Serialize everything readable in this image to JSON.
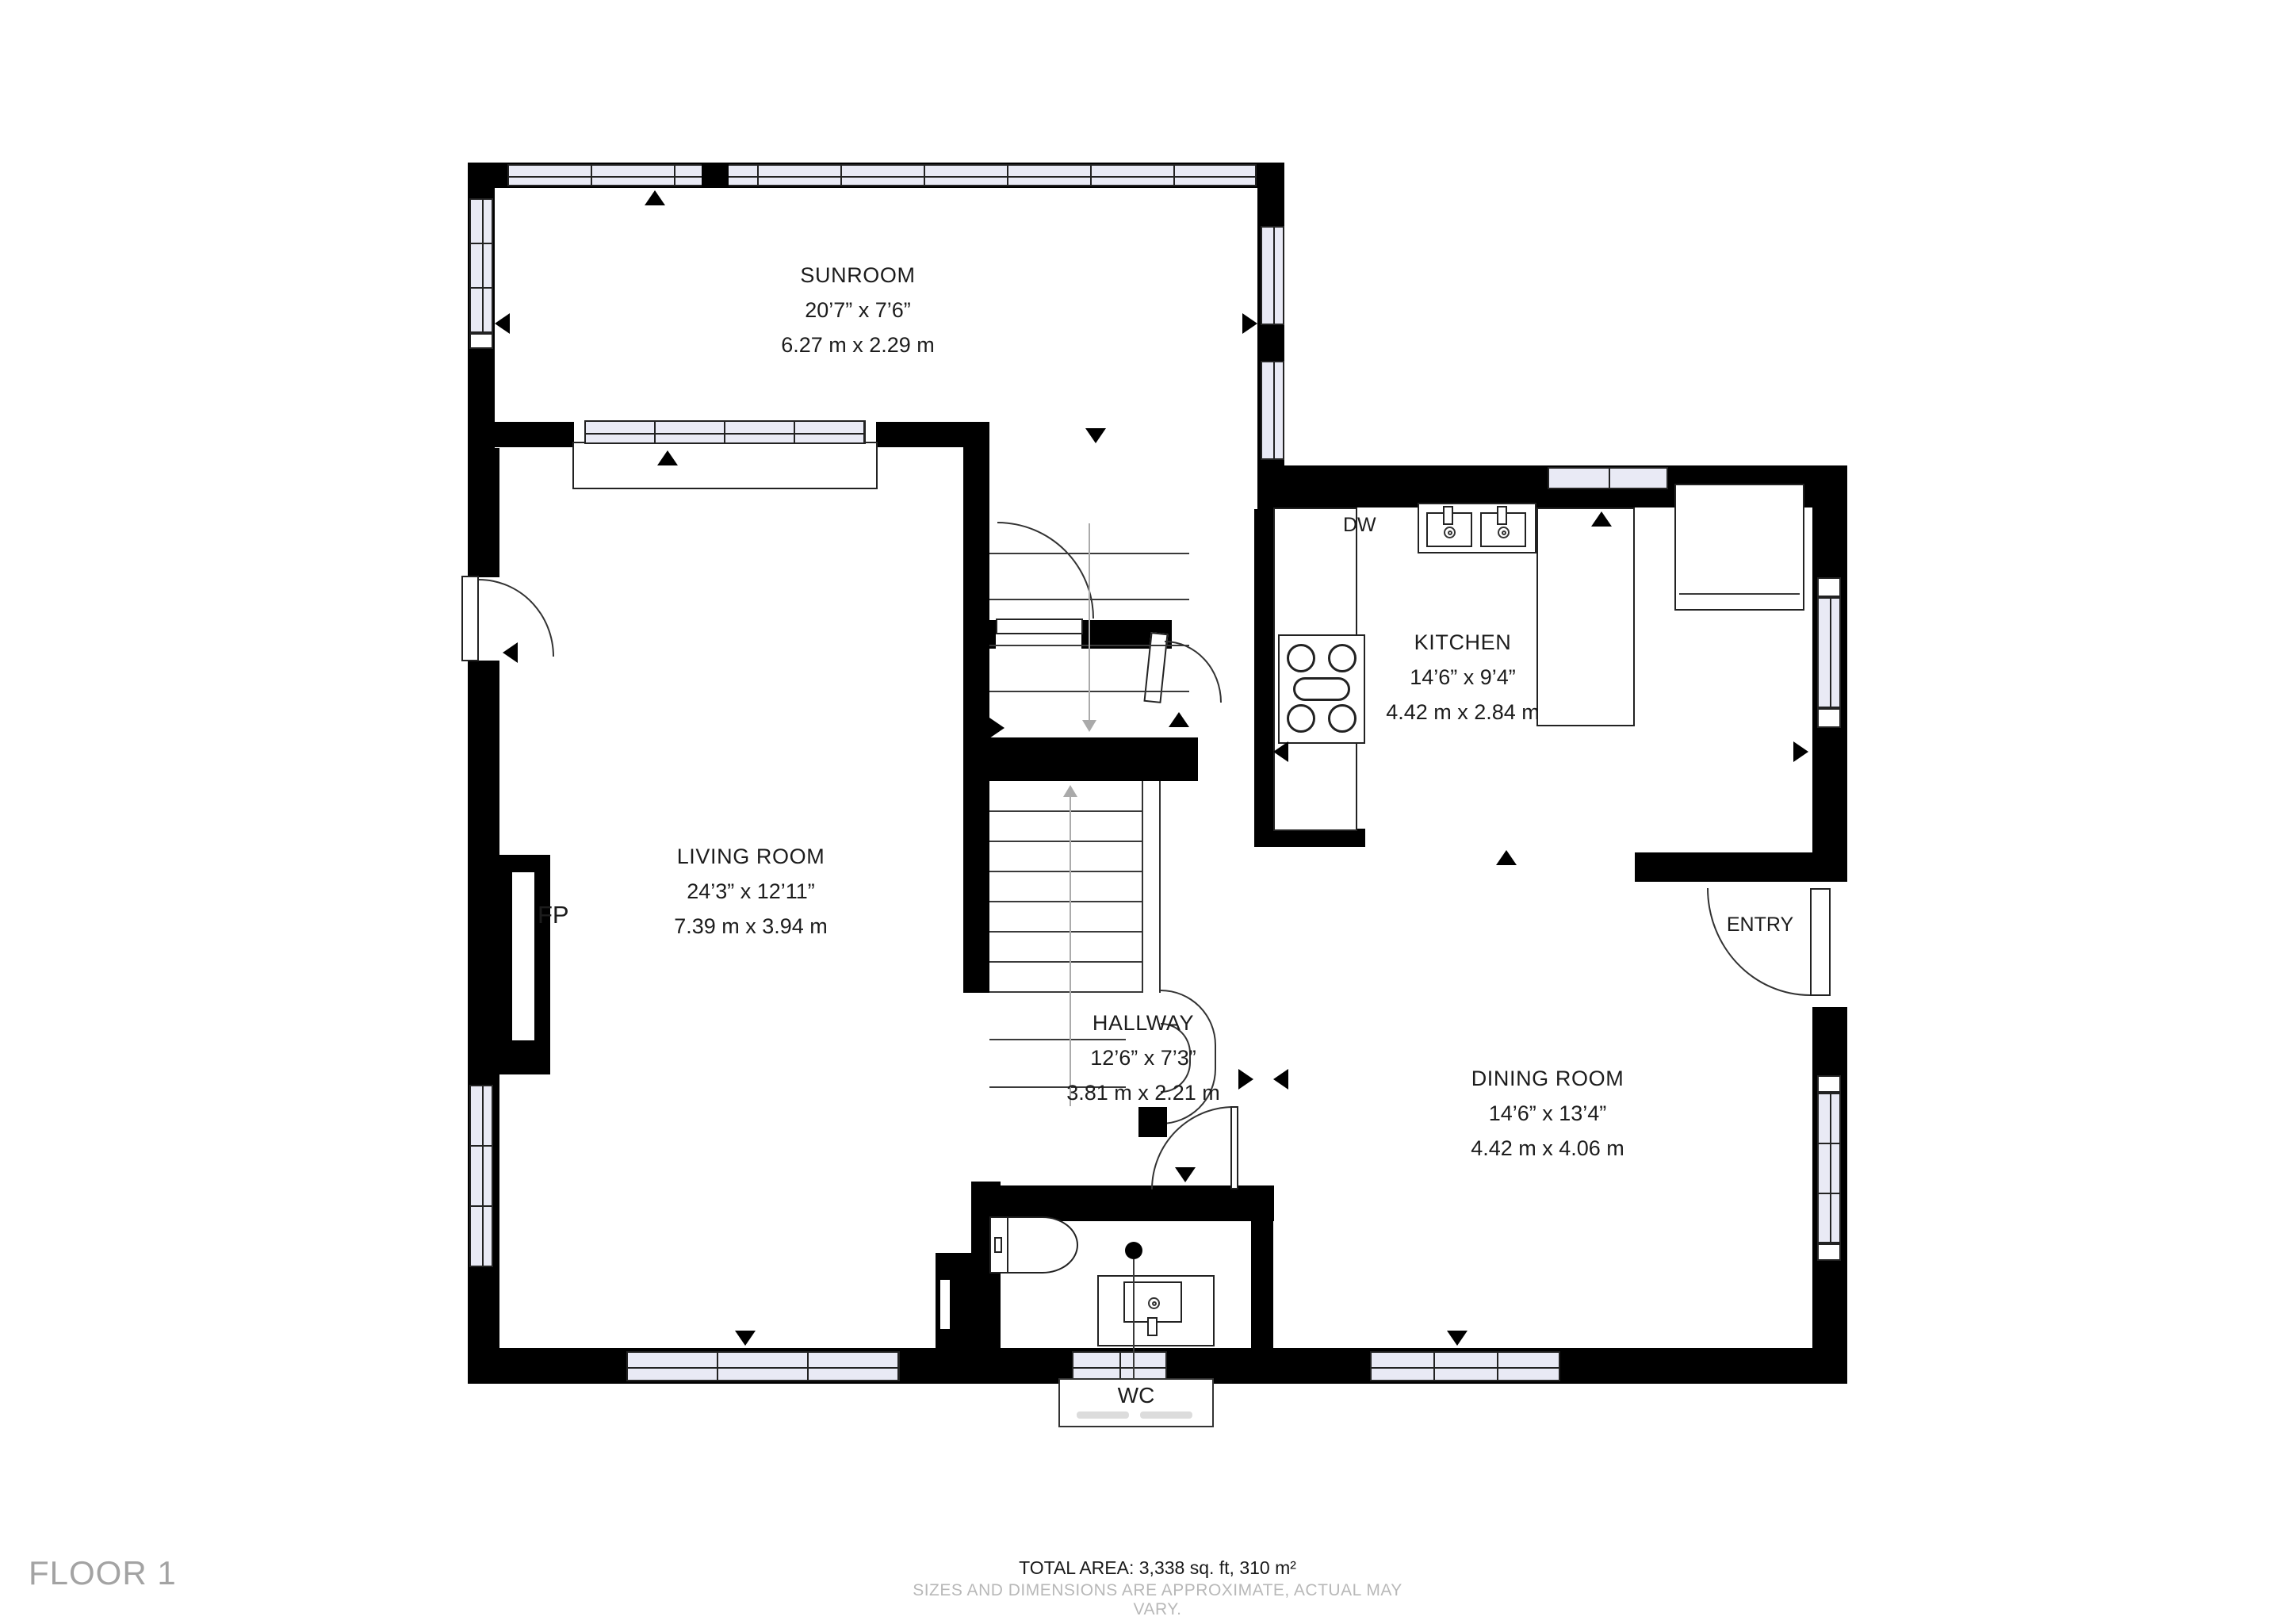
{
  "floor_label": "FLOOR 1",
  "footer": {
    "total_area": "TOTAL AREA: 3,338 sq. ft, 310 m²",
    "disclaimer": "SIZES AND DIMENSIONS ARE APPROXIMATE, ACTUAL MAY VARY."
  },
  "rooms": {
    "sunroom": {
      "name": "SUNROOM",
      "imperial": "20’7” x 7’6”",
      "metric": "6.27 m x 2.29 m"
    },
    "living": {
      "name": "LIVING ROOM",
      "imperial": "24’3” x 12’11”",
      "metric": "7.39 m x 3.94 m"
    },
    "kitchen": {
      "name": "KITCHEN",
      "imperial": "14’6” x 9’4”",
      "metric": "4.42 m x 2.84 m"
    },
    "hallway": {
      "name": "HALLWAY",
      "imperial": "12’6” x 7’3”",
      "metric": "3.81 m x 2.21 m"
    },
    "dining": {
      "name": "DINING ROOM",
      "imperial": "14’6” x 13’4”",
      "metric": "4.42 m x 4.06 m"
    }
  },
  "labels": {
    "entry": "ENTRY",
    "fireplace": "FP",
    "dishwasher": "DW",
    "wc": "WC"
  },
  "colors": {
    "wall": "#000000",
    "window_fill": "#E9EAF5",
    "line": "#3a3a3a",
    "muted_text": "#a3a3a3",
    "faint_text": "#b8b8b8"
  }
}
